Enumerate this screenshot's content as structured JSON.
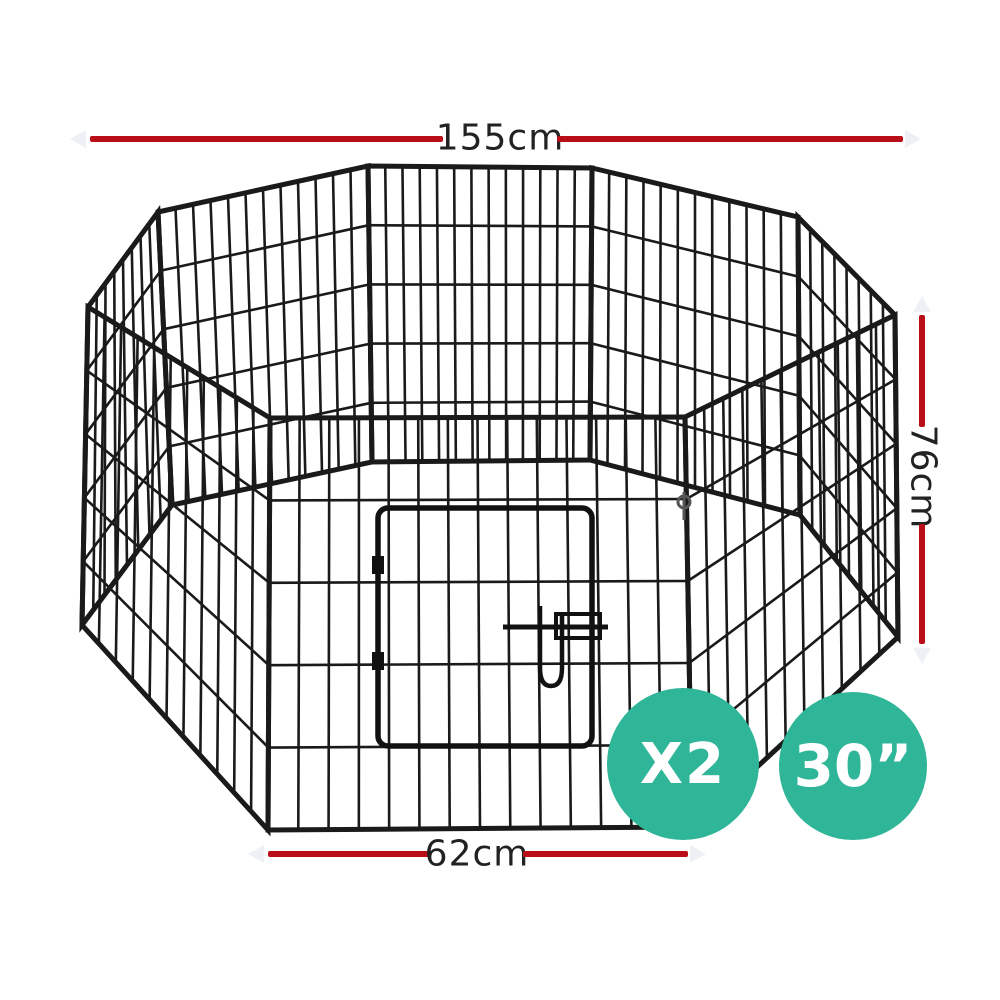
{
  "image": {
    "background_color": "#ffffff",
    "alt": "Octagonal 8-panel black wire pet playpen with front door, shown with dimension annotations"
  },
  "dimensions": {
    "line_color": "#b90e18",
    "text_color": "#222222",
    "top": {
      "label": "155cm"
    },
    "right": {
      "label": "76cm"
    },
    "bottom": {
      "label": "62cm"
    }
  },
  "badges": [
    {
      "label": "X2",
      "color": "#2fb597",
      "text_color": "#ffffff"
    },
    {
      "label": "30”",
      "color": "#2fb597",
      "text_color": "#ffffff"
    }
  ]
}
